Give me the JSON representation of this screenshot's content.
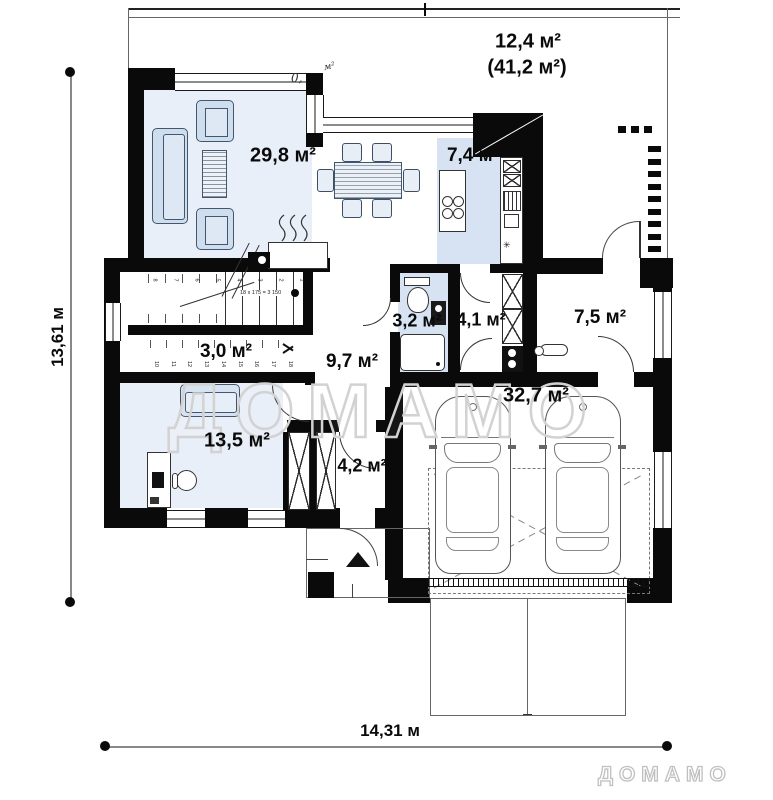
{
  "brand": {
    "watermark": "ДОМАМО",
    "logo": "ДОМАМО"
  },
  "dimensions": {
    "horizontal": "14,31 м",
    "vertical": "13,61 м"
  },
  "terrace": {
    "area": "12,4 м²",
    "area_total": "(41,2 м²)",
    "flue_prefix": "0,",
    "flue_suffix": "м²"
  },
  "rooms": [
    {
      "id": "living",
      "area": "29,8 м²"
    },
    {
      "id": "kitchen",
      "area": "7,4 м²"
    },
    {
      "id": "bathroom",
      "area": "3,2 м²"
    },
    {
      "id": "corridor",
      "area": "4,1 м²"
    },
    {
      "id": "utility",
      "area": "7,5 м²"
    },
    {
      "id": "storage",
      "area": "3,0 м²"
    },
    {
      "id": "hall",
      "area": "9,7 м²"
    },
    {
      "id": "office",
      "area": "13,5 м²"
    },
    {
      "id": "vestibule",
      "area": "4,2 м²"
    },
    {
      "id": "garage",
      "area": "32,7 м²"
    }
  ],
  "stairs": {
    "formula": "18 x 175 = 3 150",
    "up": [
      "8",
      "7",
      "6",
      "5",
      "4",
      "3",
      "2",
      "1"
    ],
    "down": [
      "10",
      "11",
      "12",
      "13",
      "14",
      "15",
      "16",
      "17",
      "18"
    ]
  },
  "symbols": {
    "kitchen_star": "✳"
  }
}
